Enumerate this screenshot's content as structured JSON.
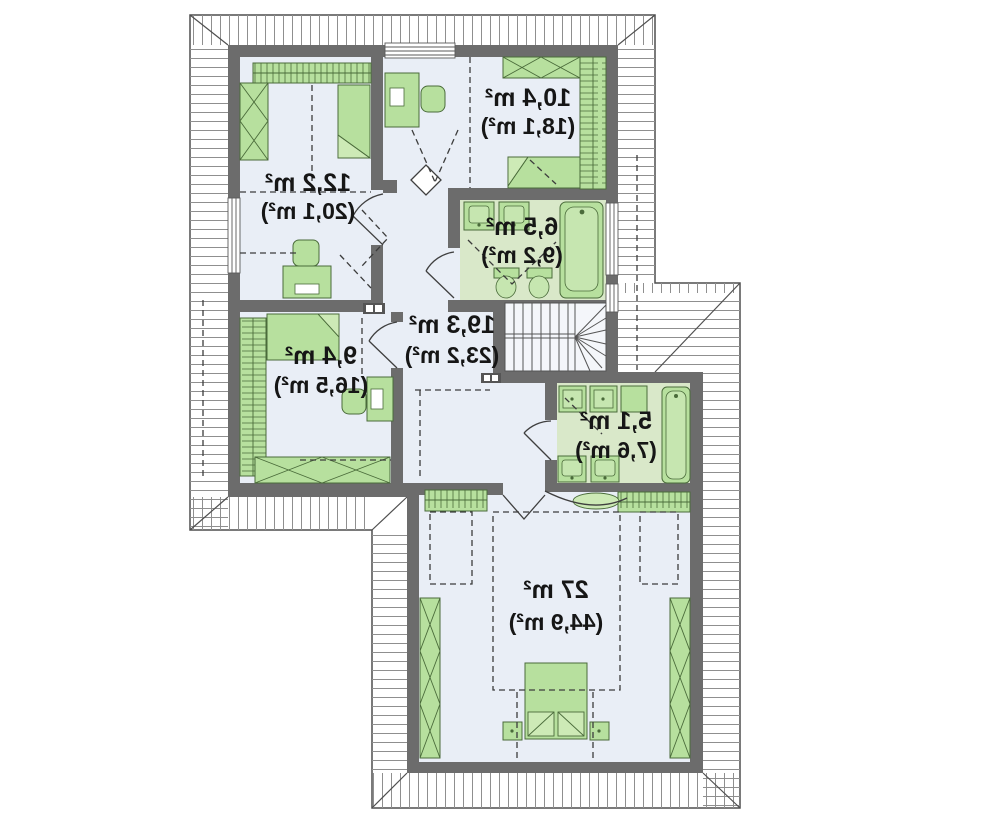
{
  "plan": {
    "type": "attic-floor-plan",
    "text_mirrored": true,
    "rooms": [
      {
        "id": "bedroom-north",
        "area": "10,4 m²",
        "gross_area": "(18,1 m²)"
      },
      {
        "id": "bedroom-west",
        "area": "12,2 m²",
        "gross_area": "(20,1 m²)"
      },
      {
        "id": "bathroom-north",
        "area": "6,5 m²",
        "gross_area": "(9,2 m²)"
      },
      {
        "id": "hall",
        "area": "19,3 m²",
        "gross_area": "(23,2 m²)"
      },
      {
        "id": "bedroom-southwest",
        "area": "9,4 m²",
        "gross_area": "(16,5 m²)"
      },
      {
        "id": "bathroom-south",
        "area": "5,1 m²",
        "gross_area": "(7,6 m²)"
      },
      {
        "id": "master-bedroom",
        "area": "27 m²",
        "gross_area": "(44,9 m²)"
      }
    ],
    "colors": {
      "wall": "#6c6c6c",
      "floor": "#e9eef6",
      "bathroom_floor": "#d9e8c9",
      "furniture": "#b7e09e",
      "furniture_outline": "#4a6b3a",
      "label": "#161616",
      "roof_line": "#4f4f4f",
      "background": "#ffffff"
    }
  }
}
